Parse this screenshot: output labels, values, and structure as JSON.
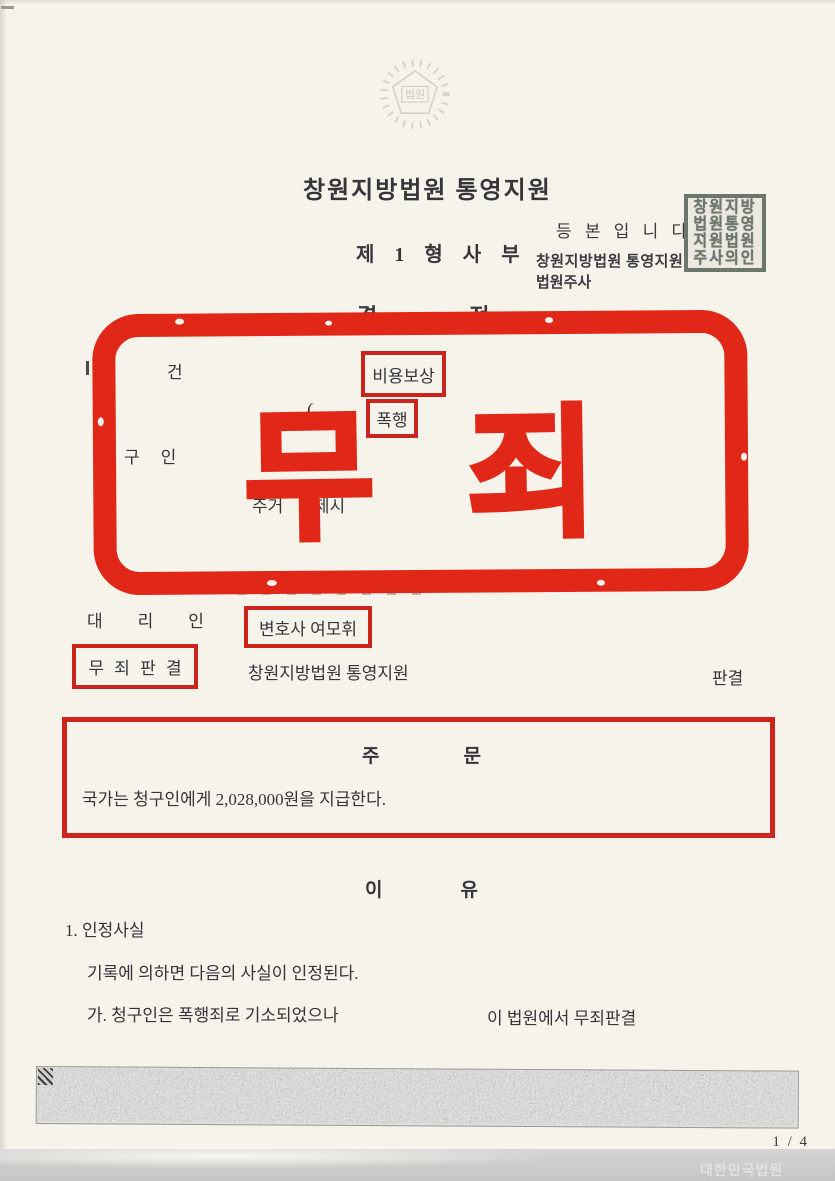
{
  "meta": {
    "accent_red": "#e12818",
    "box_red": "#cb241c",
    "seal_gray": "#6d756f"
  },
  "emblem": {
    "label": "법원"
  },
  "header": {
    "court_title": "창원지방법원 통영지원",
    "division": "제 1 형 사 부",
    "doc_title_char1": "결",
    "doc_title_char2": "정"
  },
  "certification": {
    "stamp_line": "등 본 입 니 다 .",
    "court": "창원지방법원 통영지원",
    "clerk": "법원주사",
    "seal_rows": [
      "창원지방",
      "법원통영",
      "지원법원",
      "주사의인"
    ]
  },
  "case_section": {
    "case_label": "건",
    "case_value_boxed": "비용보상",
    "open_paren": "(",
    "charge_boxed": "폭행",
    "claimant_label_char1": "구",
    "claimant_label_char2": "인",
    "claimant_partial": "이",
    "residence_label": "주거",
    "residence_value": "거제시"
  },
  "not_guilty_stamp": {
    "char1": "무",
    "char2": "죄"
  },
  "representative": {
    "label_char1": "대",
    "label_char2": "리",
    "label_char3": "인",
    "value_boxed": "변호사 여모휘"
  },
  "verdict_line": {
    "boxed": "무 죄 판 결",
    "court": "창원지방법원 통영지원",
    "suffix": "판결"
  },
  "jumun": {
    "title_char1": "주",
    "title_char2": "문",
    "body": "국가는 청구인에게 2,028,000원을 지급한다."
  },
  "reasons": {
    "title_char1": "이",
    "title_char2": "유",
    "item_number": "1. 인정사실",
    "line1": "기록에 의하면 다음의 사실이 인정된다.",
    "line2_left": "가. 청구인은 폭행죄로 기소되었으나",
    "line2_right": "이 법원에서 무죄판결"
  },
  "footer": {
    "page_indicator": "1 / 4",
    "watermark": "대한민국법원"
  }
}
